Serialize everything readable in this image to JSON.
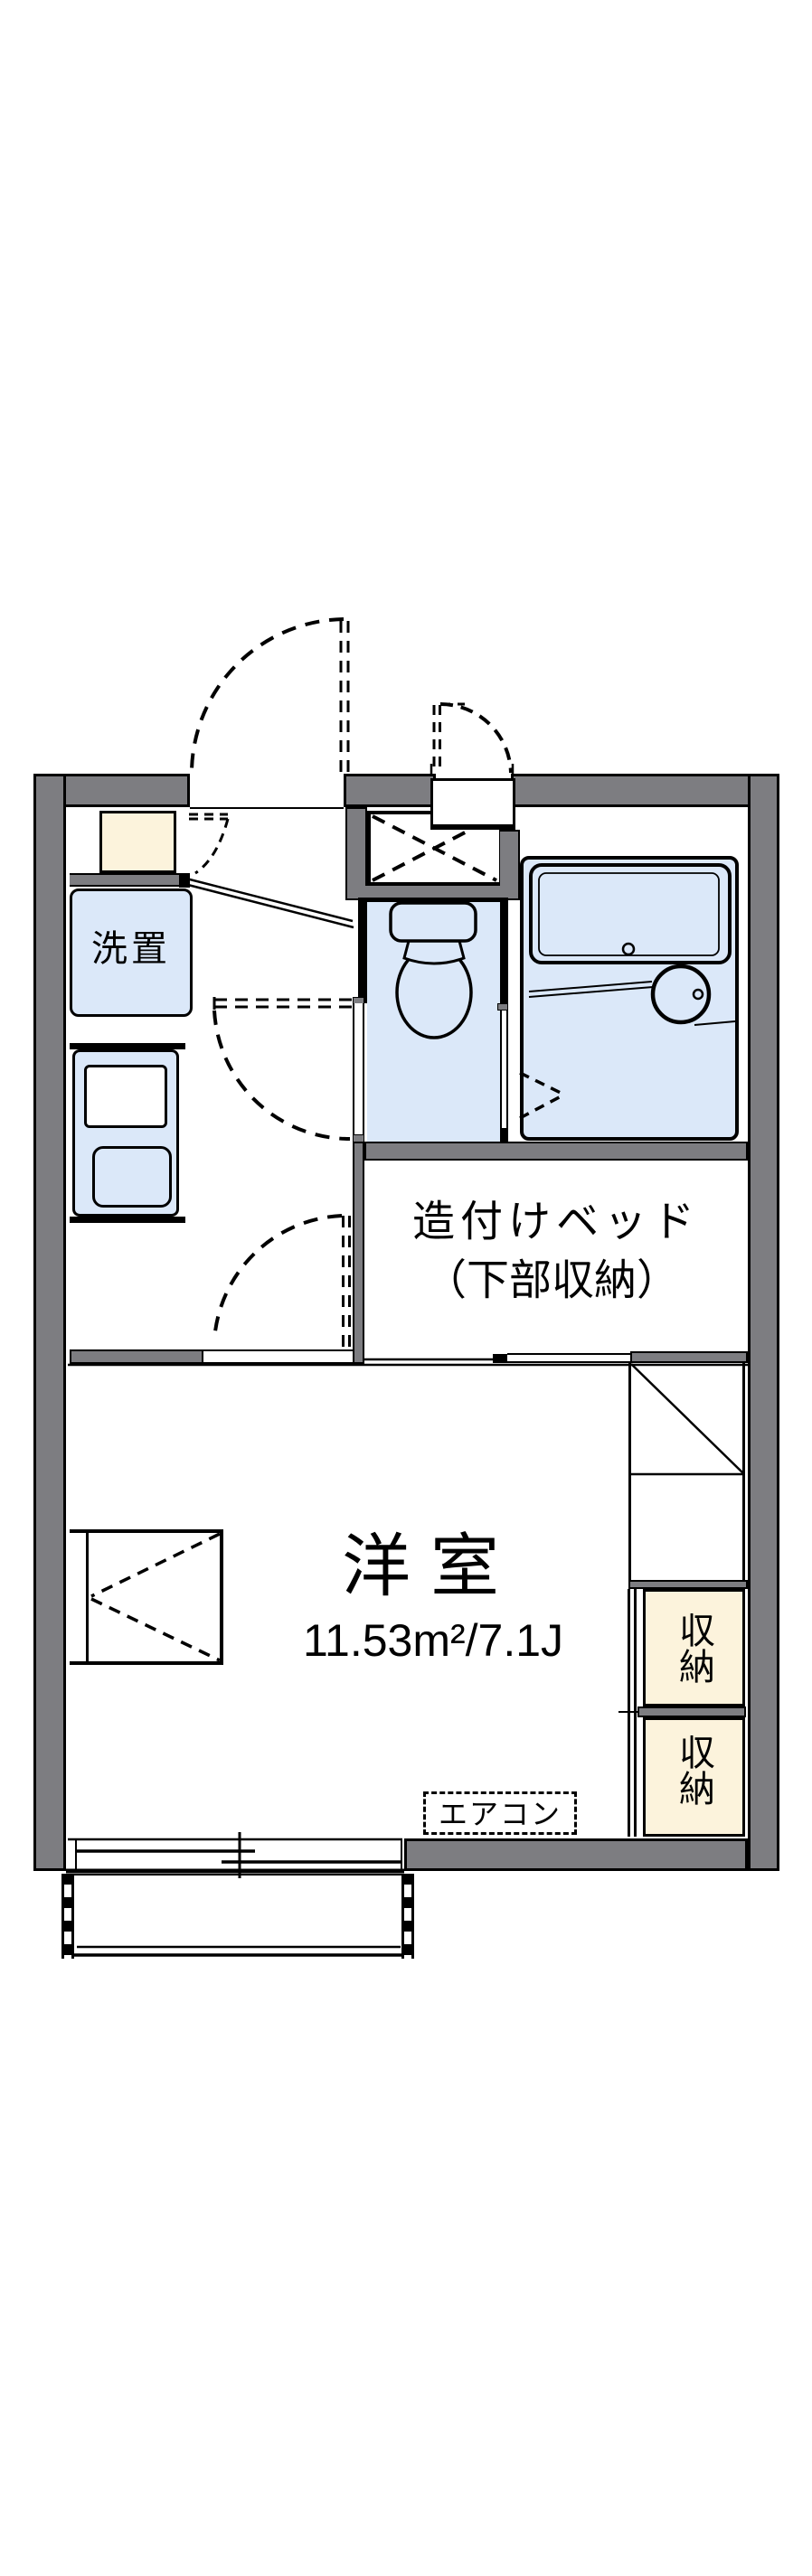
{
  "plan": {
    "labels": {
      "laundry": "洗置",
      "built_in_bed": "造付けベッド",
      "built_in_bed_note": "（下部収納）",
      "western_room": "洋室",
      "western_room_area": "11.53m²/7.1J",
      "air_conditioner": "エアコン",
      "storage_upper": "収納",
      "storage_lower": "収納"
    },
    "colors": {
      "wall": "#7D7D81",
      "wet_area": "#DBE8F9",
      "storage": "#FCF3DC",
      "line": "#000000",
      "background": "#FFFFFF"
    }
  }
}
